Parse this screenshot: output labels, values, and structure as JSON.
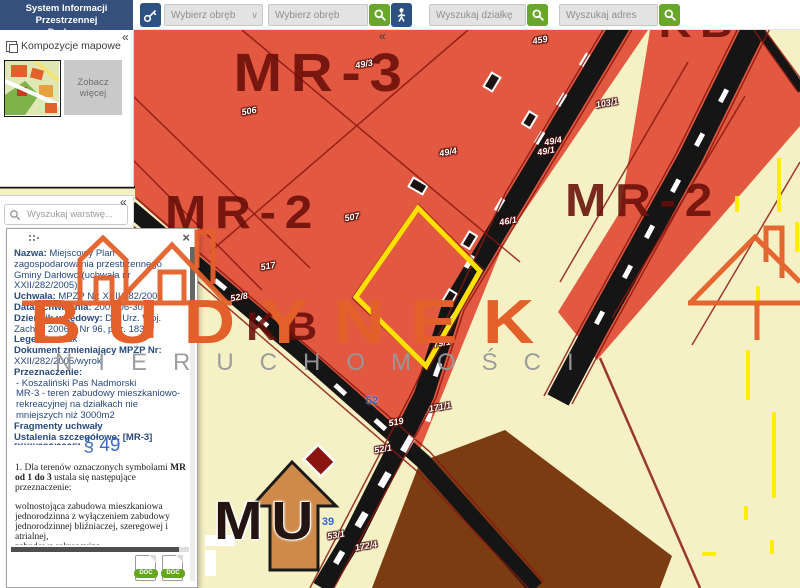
{
  "app": {
    "title_line1": "System Informacji Przestrzennej",
    "title_line2": "Darłowo"
  },
  "icons": {
    "collapse": "«",
    "chevron": "∨",
    "close": "×"
  },
  "toolbar": {
    "region_select_placeholder": "Wybierz obręb",
    "region_search_placeholder": "Wybierz obręb",
    "parcel_search_placeholder": "Wyszukaj działkę",
    "address_search_placeholder": "Wyszukaj adres"
  },
  "compositions_panel": {
    "title": "Kompozycje mapowe",
    "see_more_label": "Zobacz więcej"
  },
  "layers_panel": {
    "search_placeholder": "Wyszukaj warstwę..."
  },
  "info_panel": {
    "fields": [
      {
        "label": "Nazwa:",
        "value": "Miejscowy Plan zagospodarowania przestrzennego Gminy Darłowo (uchwała nr XXII/282/2005)"
      },
      {
        "label": "Uchwała:",
        "value": "MPZP Nr: XXII/282/2005"
      },
      {
        "label": "Data uchwalenia:",
        "value": "2005-06-30"
      },
      {
        "label": "Dziennik urzędowy:",
        "value": "Dz. Urz. Woj. Zach. z 2006 r. Nr 96, poz. 1835"
      },
      {
        "label": "Legenda:",
        "value": "brak"
      },
      {
        "label": "Dokument zmieniający MPZP Nr:",
        "value": "XXII/282/2005/wyrok"
      },
      {
        "label": "Przeznaczenie:",
        "value": ""
      }
    ],
    "destination_items": [
      "- Koszaliński Pas Nadmorski",
      "MR-3 - teren zabudowy mieszkaniowo-rekreacyjnej na działkach nie mniejszych niż 3000m2"
    ],
    "fragments_heading": "Fragmenty uchwały",
    "details_heading": "Ustalenia szczegółowe: [MR-3] [XXII/282/2005]",
    "paragraph_ref": "§ 49",
    "excerpt": {
      "intro_pre": "1. Dla terenów oznaczonych symbolami ",
      "intro_bold": "MR od 1 do 3",
      "intro_post": " ustala się następujące przeznaczenie:",
      "items": [
        "wolnostojąca zabudowa mieszkaniowa jednorodzinna z wyłączeniem zabudowy jednorodzinnej bliźniaczej, szeregowej i atrialnej,",
        "zabudowa rekreacyjna,",
        "drogi wewnętrzne,"
      ]
    },
    "attachments": [
      {
        "label": "DOC"
      },
      {
        "label": "DOC"
      }
    ]
  },
  "map": {
    "zone_labels": [
      "MR-3",
      "MR-2",
      "MR-2",
      "KB",
      "KB",
      "MU"
    ],
    "parcel_labels": [
      "459",
      "49/3",
      "506",
      "103/1",
      "49/4",
      "49/4",
      "49/1",
      "507",
      "46/1",
      "517",
      "52/8",
      "79/1",
      "171/1",
      "519",
      "52/1",
      "53/1",
      "172/4"
    ],
    "address_labels": [
      "52",
      "39"
    ]
  },
  "watermark": {
    "line1": "BUDYNEK",
    "line2": "NIERUCHOMOŚCI"
  },
  "colors": {
    "accent_blue": "#2d5181",
    "accent_green": "#69a72b",
    "zone_orange": "#e25840",
    "zone_pale": "#f6f1c4",
    "zone_label_red": "#7c150f",
    "highlight_yellow": "#ffe000",
    "watermark_orange": "#e4602a",
    "watermark_gray": "#97999c",
    "info_text_navy": "#27497e"
  }
}
